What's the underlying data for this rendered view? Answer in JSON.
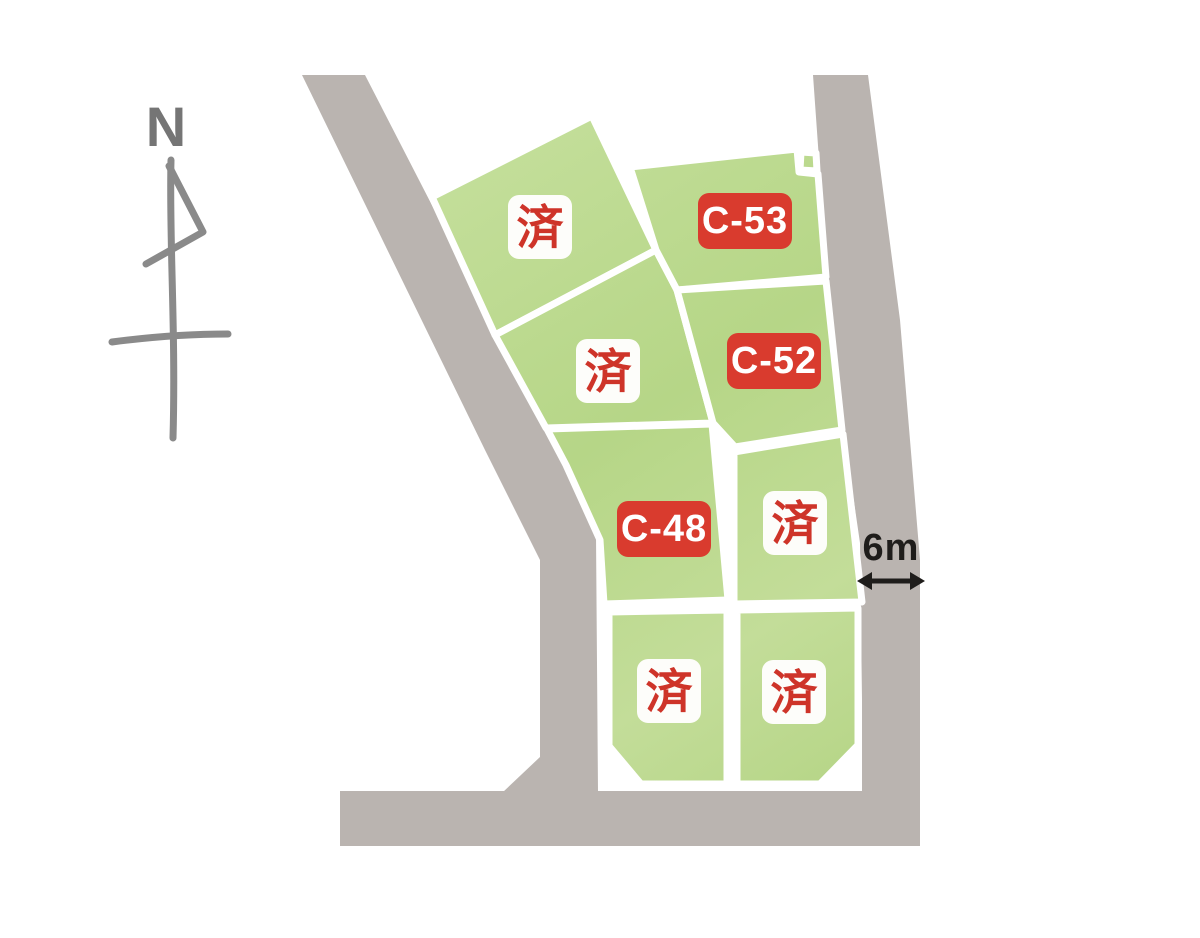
{
  "compass": {
    "north_label": "N"
  },
  "road": {
    "width_label": "6m"
  },
  "plots": [
    {
      "name": "plot-northwest-upper",
      "label": "済",
      "status": "sold"
    },
    {
      "name": "plot-c53",
      "label": "C-53",
      "status": "available"
    },
    {
      "name": "plot-northwest-lower",
      "label": "済",
      "status": "sold"
    },
    {
      "name": "plot-c52",
      "label": "C-52",
      "status": "available"
    },
    {
      "name": "plot-c48",
      "label": "C-48",
      "status": "available"
    },
    {
      "name": "plot-middle-right",
      "label": "済",
      "status": "sold"
    },
    {
      "name": "plot-bottom-left",
      "label": "済",
      "status": "sold"
    },
    {
      "name": "plot-bottom-right",
      "label": "済",
      "status": "sold"
    }
  ],
  "colors": {
    "plot_green": "#bcd990",
    "plot_green_light": "#c9e2a4",
    "plot_green_deep": "#b2d382",
    "road_gray": "#bab4b0",
    "label_red": "#d93b2e",
    "sold_text_red": "#ce3429",
    "label_white": "#fdfdfa",
    "compass_gray": "#8a8a8a",
    "ink_black": "#1f1d1b"
  }
}
